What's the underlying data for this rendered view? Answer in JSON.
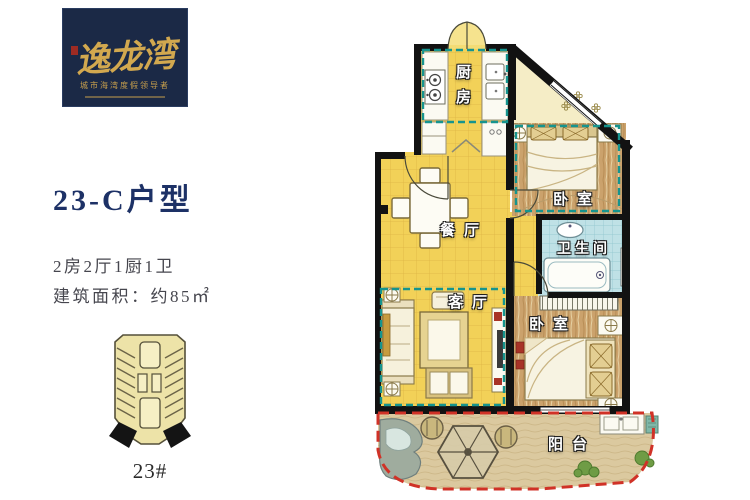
{
  "colors": {
    "logo_bg": "#1B2946",
    "logo_gold": "#D2A84F",
    "title_navy": "#1D3166",
    "text_gray": "#46464E",
    "wall_black": "#121212",
    "floor_yellow": "#F2D158",
    "floor_wood": "#CBA26C",
    "bathroom_tile_blue": "#BFE1E6",
    "balcony_sand": "#DBC99F",
    "dash_teal": "#16948E",
    "dash_red": "#D03227",
    "building_fill": "#EDE3A8"
  },
  "logo": {
    "brand": "逸龙湾",
    "tagline": "城市海湾度假领导者"
  },
  "unit": {
    "title": "23-C户型",
    "layout": "2房2厅1厨1卫",
    "area": "建筑面积：约85㎡"
  },
  "building": {
    "label": "23#"
  },
  "floorplan": {
    "rooms": [
      {
        "id": "kitchen",
        "label": "厨房"
      },
      {
        "id": "dining",
        "label": "餐厅"
      },
      {
        "id": "bedroom-top",
        "label": "卧室"
      },
      {
        "id": "bathroom",
        "label": "卫生间"
      },
      {
        "id": "living",
        "label": "客厅"
      },
      {
        "id": "bedroom-bottom",
        "label": "卧室"
      },
      {
        "id": "balcony",
        "label": "阳台"
      }
    ]
  }
}
